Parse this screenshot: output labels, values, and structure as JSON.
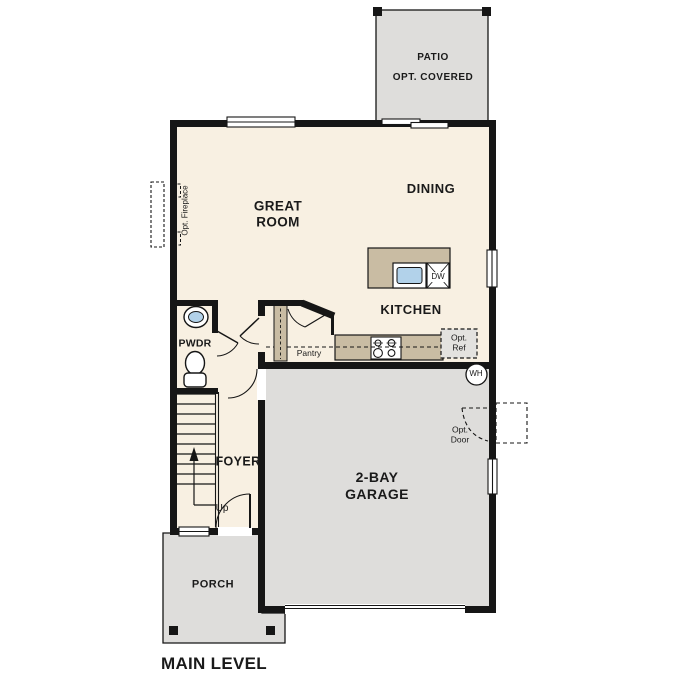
{
  "plan": {
    "title": "MAIN LEVEL",
    "palette": {
      "wall": "#161616",
      "interior": "#f8f0e2",
      "outdoor": "#dedddb",
      "cabinet": "#c9bca3",
      "sink": "#b2d2ea",
      "ink": "#1a1a1a",
      "refbox": "#e3e2df"
    },
    "rooms": {
      "patio": {
        "name": "PATIO",
        "note": "OPT. COVERED"
      },
      "great_room": {
        "name": "GREAT ROOM"
      },
      "dining": {
        "name": "DINING"
      },
      "kitchen": {
        "name": "KITCHEN"
      },
      "powder": {
        "name": "PWDR"
      },
      "pantry": {
        "name": "Pantry"
      },
      "foyer": {
        "name": "FOYER"
      },
      "garage": {
        "name": "2-BAY GARAGE"
      },
      "porch": {
        "name": "PORCH"
      }
    },
    "annotations": {
      "up": "Up",
      "water_heater": "WH",
      "dishwasher": "DW",
      "opt_ref": "Opt. Ref",
      "opt_door": "Opt. Door",
      "opt_fireplace": "Opt. Fireplace"
    }
  }
}
